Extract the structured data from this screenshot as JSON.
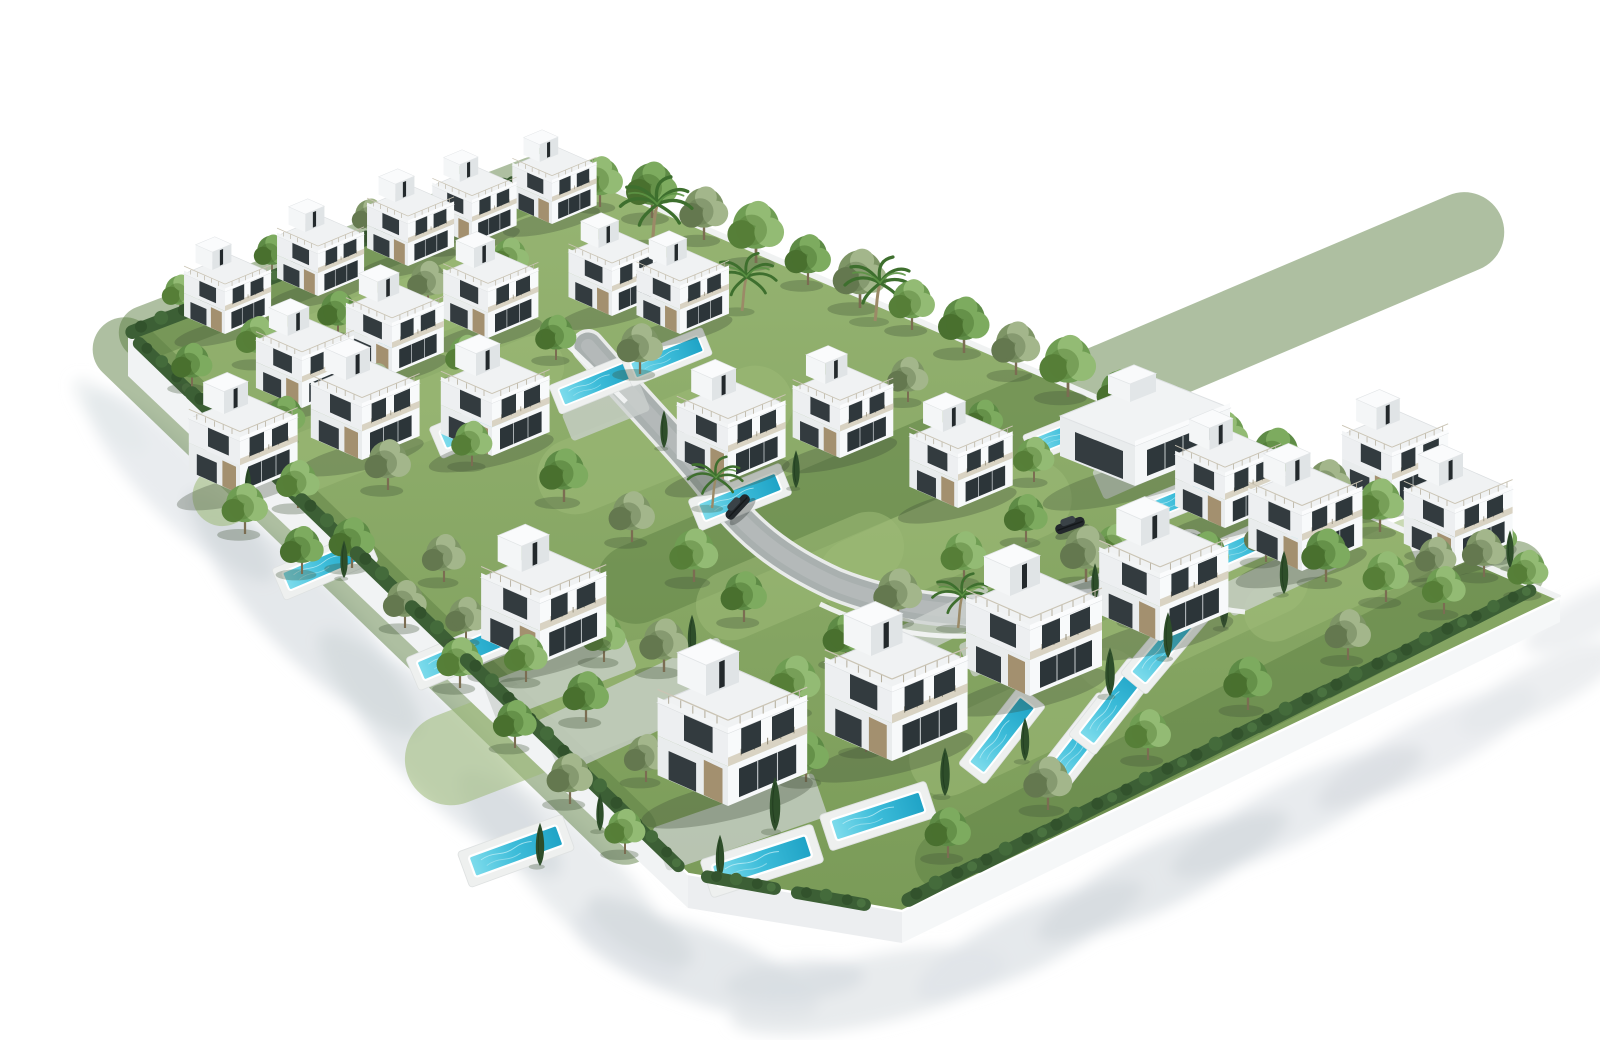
{
  "meta": {
    "description": "Aerial 3D architectural rendering of a gated residential development: twenty-five white modern villas with rooftop terraces and stair towers, private turquoise swimming pools, dense green landscaping with palms and cypresses, a curved grey access road with two dark cars, all enclosed by a white perimeter wall casting soft shadows on a white background."
  },
  "scene": {
    "canvas": {
      "w": 1600,
      "h": 1024,
      "bg": "#ffffff"
    },
    "palette": {
      "lawn_top": "#97b573",
      "lawn_bottom": "#7a9b58",
      "lawn_light": "#9cba77",
      "lawn_dark": "#5d7f43",
      "wall_sw": "#f1f3f4",
      "wall_s": "#eceef0",
      "wall_se": "#f5f7f8",
      "wall_line": "#f0f2f2",
      "road_curb": "#e9ebea",
      "road": "#a9b0af",
      "road_center": "#b6bcbb",
      "paving": "#ccd1cf",
      "inner_wall": "#f2f4f4",
      "pool_deep": "#1fa3c6",
      "pool_mid": "#3cbcd9",
      "pool_light": "#7edcec",
      "villa_white": "#f7f9fa",
      "villa_shade": "#e9eced",
      "glass": "#2c3539",
      "stone": "#a3906f",
      "car_body": "#23282c",
      "tree_variants": [
        {
          "c1": "#5e8b46",
          "c2": "#49702f",
          "c3": "#7dab5f"
        },
        {
          "c1": "#6f9d53",
          "c2": "#567f38",
          "c3": "#93bb74"
        },
        {
          "c1": "#7e9566",
          "c2": "#64784f",
          "c3": "#a3b68b"
        }
      ]
    },
    "plot": {
      "outline": [
        [
          88,
          318
        ],
        [
          520,
          150
        ],
        [
          1520,
          582
        ],
        [
          862,
          895
        ],
        [
          648,
          858
        ]
      ],
      "wall_sw": [
        [
          88,
          318
        ],
        [
          648,
          858
        ],
        [
          648,
          892
        ],
        [
          88,
          360
        ]
      ],
      "wall_s": [
        [
          648,
          858
        ],
        [
          862,
          895
        ],
        [
          862,
          927
        ],
        [
          648,
          892
        ]
      ],
      "wall_se": [
        [
          862,
          895
        ],
        [
          1520,
          582
        ],
        [
          1520,
          606
        ],
        [
          862,
          927
        ]
      ],
      "edge_nw": [
        [
          88,
          318
        ],
        [
          520,
          150
        ]
      ],
      "edge_ne": [
        [
          520,
          150
        ],
        [
          1520,
          582
        ]
      ]
    },
    "road": {
      "d": "M548,330 C600,390 640,430 672,470 C706,515 740,543 795,568 C855,592 925,600 985,593 C1048,586 1096,562 1150,530",
      "inner_walls": [
        "M780,588 C830,612 880,622 930,620",
        "M1086,556 C1130,580 1166,592 1205,596",
        "M515,318 C540,340 562,362 586,386"
      ]
    },
    "lawn_light_patches": [
      [
        350,
        302,
        230,
        64,
        -21
      ],
      [
        625,
        424,
        270,
        76,
        -22
      ],
      [
        905,
        522,
        270,
        78,
        -24
      ],
      [
        1152,
        602,
        250,
        70,
        -25
      ],
      [
        508,
        706,
        300,
        92,
        -21
      ],
      [
        252,
        452,
        210,
        60,
        -22
      ],
      [
        1302,
        564,
        210,
        60,
        -25
      ],
      [
        986,
        706,
        250,
        74,
        -25
      ],
      [
        420,
        380,
        220,
        60,
        -22
      ],
      [
        760,
        560,
        220,
        70,
        -23
      ]
    ],
    "lawn_dark_patches": [
      [
        300,
        242,
        470,
        54,
        -21
      ],
      [
        1010,
        392,
        980,
        80,
        -23
      ],
      [
        335,
        575,
        760,
        64,
        44
      ],
      [
        1190,
        700,
        700,
        60,
        -27
      ]
    ],
    "paving_patches": [
      [
        566,
        396,
        84,
        30,
        -22
      ],
      [
        1102,
        450,
        96,
        32,
        -24
      ],
      [
        908,
        606,
        100,
        34,
        -26
      ],
      [
        700,
        806,
        170,
        46,
        -19
      ],
      [
        520,
        660,
        150,
        40,
        -21
      ],
      [
        980,
        620,
        120,
        36,
        -25
      ],
      [
        1240,
        560,
        120,
        34,
        -25
      ],
      [
        600,
        690,
        200,
        60,
        -25
      ]
    ],
    "outside_shadows": [
      [
        140,
        470,
        130,
        34,
        46,
        "#e2e6e9",
        0.75
      ],
      [
        265,
        600,
        150,
        40,
        46,
        "#dde2e6",
        0.8
      ],
      [
        400,
        735,
        150,
        42,
        46,
        "#dfe3e7",
        0.8
      ],
      [
        540,
        865,
        140,
        40,
        46,
        "#e1e5e8",
        0.75
      ],
      [
        655,
        948,
        130,
        36,
        20,
        "#dde2e6",
        0.8
      ],
      [
        828,
        975,
        140,
        34,
        -12,
        "#e0e4e7",
        0.75
      ],
      [
        190,
        520,
        60,
        20,
        46,
        "#d3d9dd",
        0.7
      ],
      [
        330,
        668,
        70,
        24,
        46,
        "#d2d8dc",
        0.7
      ],
      [
        470,
        808,
        70,
        24,
        46,
        "#d4dade",
        0.7
      ],
      [
        600,
        915,
        60,
        22,
        30,
        "#d3d9dd",
        0.7
      ],
      [
        755,
        965,
        70,
        20,
        -5,
        "#d6dbdf",
        0.7
      ],
      [
        985,
        925,
        120,
        30,
        -26,
        "#dfe3e7",
        0.8
      ],
      [
        1120,
        860,
        130,
        32,
        -26,
        "#dde2e6",
        0.8
      ],
      [
        1255,
        795,
        130,
        30,
        -27,
        "#e0e4e8",
        0.75
      ],
      [
        1390,
        730,
        120,
        28,
        -27,
        "#e2e6e9",
        0.7
      ],
      [
        1500,
        672,
        90,
        24,
        -27,
        "#e4e7ea",
        0.7
      ],
      [
        1050,
        895,
        60,
        18,
        -26,
        "#d5dade",
        0.65
      ],
      [
        1190,
        828,
        65,
        20,
        -26,
        "#d4d9dd",
        0.65
      ],
      [
        1330,
        762,
        60,
        18,
        -27,
        "#d6dbdf",
        0.6
      ],
      [
        70,
        400,
        50,
        16,
        46,
        "#e3e7ea",
        0.6
      ],
      [
        1548,
        600,
        70,
        22,
        -27,
        "#e3e6e9",
        0.6
      ]
    ],
    "villas": [
      [
        185,
        318,
        0.64
      ],
      [
        278,
        280,
        0.64
      ],
      [
        368,
        250,
        0.64
      ],
      [
        432,
        228,
        0.62
      ],
      [
        512,
        208,
        0.62
      ],
      [
        262,
        392,
        0.72
      ],
      [
        352,
        358,
        0.72
      ],
      [
        448,
        322,
        0.7
      ],
      [
        572,
        300,
        0.68
      ],
      [
        640,
        318,
        0.68
      ],
      [
        200,
        478,
        0.8
      ],
      [
        322,
        444,
        0.8
      ],
      [
        452,
        440,
        0.8
      ],
      [
        688,
        465,
        0.8
      ],
      [
        800,
        442,
        0.74
      ],
      [
        918,
        492,
        0.76
      ],
      [
        1185,
        512,
        0.78
      ],
      [
        1352,
        492,
        0.78
      ],
      [
        1262,
        555,
        0.84
      ],
      [
        1415,
        550,
        0.8
      ],
      [
        500,
        648,
        0.92
      ],
      [
        688,
        790,
        1.1
      ],
      [
        852,
        745,
        1.05
      ],
      [
        990,
        680,
        1.0
      ],
      [
        1120,
        625,
        0.95
      ]
    ],
    "clubhouse": [
      [
        1095,
        470,
        1.0
      ]
    ],
    "pools": [
      [
        338,
        335,
        -23,
        0.78
      ],
      [
        441,
        408,
        -23,
        0.8
      ],
      [
        557,
        367,
        -22,
        0.74
      ],
      [
        627,
        341,
        -22,
        0.7
      ],
      [
        700,
        481,
        -22,
        0.8
      ],
      [
        285,
        549,
        -23,
        0.82
      ],
      [
        421,
        638,
        -23,
        0.85
      ],
      [
        476,
        835,
        -20,
        0.9
      ],
      [
        722,
        845,
        -18,
        0.95
      ],
      [
        838,
        800,
        -18,
        0.9
      ],
      [
        1040,
        728,
        -52,
        0.85
      ],
      [
        962,
        719,
        -52,
        0.8
      ],
      [
        1072,
        690,
        -52,
        0.8
      ],
      [
        1125,
        630,
        -50,
        0.8
      ],
      [
        1205,
        530,
        -24,
        0.8
      ],
      [
        1420,
        520,
        -24,
        0.8
      ],
      [
        1285,
        502,
        -24,
        0.75
      ],
      [
        1135,
        485,
        -22,
        0.7
      ],
      [
        1028,
        417,
        -22,
        0.7
      ]
    ],
    "trees": [
      [
        560,
        191,
        0.9,
        2
      ],
      [
        612,
        202,
        1,
        1
      ],
      [
        664,
        224,
        0.95,
        3
      ],
      [
        716,
        247,
        1.1,
        2
      ],
      [
        768,
        269,
        0.9,
        1
      ],
      [
        820,
        292,
        1.05,
        3
      ],
      [
        872,
        314,
        0.9,
        2
      ],
      [
        924,
        337,
        1,
        1
      ],
      [
        976,
        359,
        0.95,
        3
      ],
      [
        1028,
        381,
        1.1,
        2
      ],
      [
        1080,
        404,
        0.9,
        1
      ],
      [
        1132,
        426,
        1,
        3
      ],
      [
        1184,
        449,
        0.95,
        2
      ],
      [
        1236,
        471,
        1.05,
        1
      ],
      [
        1288,
        494,
        0.9,
        3
      ],
      [
        1340,
        516,
        0.95,
        2
      ],
      [
        1392,
        539,
        0.9,
        1
      ],
      [
        1444,
        561,
        0.85,
        3
      ],
      [
        1488,
        579,
        0.8,
        2
      ],
      [
        152,
        372,
        0.8,
        1
      ],
      [
        205,
        432,
        0.9,
        3
      ],
      [
        258,
        492,
        0.85,
        2
      ],
      [
        312,
        552,
        0.9,
        1
      ],
      [
        365,
        612,
        0.85,
        3
      ],
      [
        420,
        672,
        0.9,
        2
      ],
      [
        475,
        732,
        0.85,
        1
      ],
      [
        530,
        788,
        0.9,
        3
      ],
      [
        585,
        838,
        0.8,
        2
      ],
      [
        908,
        842,
        0.9,
        1
      ],
      [
        1008,
        794,
        0.95,
        3
      ],
      [
        1108,
        744,
        0.9,
        2
      ],
      [
        1208,
        694,
        0.95,
        1
      ],
      [
        1308,
        644,
        0.9,
        3
      ],
      [
        1404,
        598,
        0.85,
        2
      ],
      [
        140,
        298,
        0.7,
        2
      ],
      [
        232,
        258,
        0.7,
        1
      ],
      [
        330,
        222,
        0.7,
        3
      ],
      [
        428,
        186,
        0.7,
        2
      ],
      [
        506,
        166,
        0.65,
        1
      ],
      [
        218,
        348,
        0.85,
        2
      ],
      [
        298,
        320,
        0.8,
        1
      ],
      [
        388,
        290,
        0.8,
        3
      ],
      [
        470,
        264,
        0.75,
        2
      ],
      [
        245,
        425,
        0.8,
        1
      ],
      [
        336,
        395,
        0.85,
        3
      ],
      [
        426,
        364,
        0.8,
        2
      ],
      [
        516,
        344,
        0.8,
        1
      ],
      [
        600,
        358,
        0.9,
        3
      ],
      [
        205,
        518,
        0.9,
        2
      ],
      [
        262,
        558,
        0.85,
        1
      ],
      [
        348,
        474,
        0.9,
        3
      ],
      [
        432,
        450,
        0.8,
        2
      ],
      [
        524,
        486,
        0.95,
        1
      ],
      [
        592,
        526,
        0.9,
        3
      ],
      [
        654,
        566,
        0.95,
        2
      ],
      [
        704,
        606,
        0.9,
        1
      ],
      [
        624,
        656,
        0.95,
        3
      ],
      [
        564,
        646,
        0.85,
        2
      ],
      [
        484,
        606,
        0.9,
        1
      ],
      [
        404,
        566,
        0.85,
        3
      ],
      [
        755,
        696,
        1,
        2
      ],
      [
        806,
        648,
        0.9,
        1
      ],
      [
        858,
        606,
        0.95,
        3
      ],
      [
        924,
        566,
        0.9,
        2
      ],
      [
        986,
        526,
        0.85,
        1
      ],
      [
        1046,
        566,
        1,
        3
      ],
      [
        1106,
        606,
        0.95,
        2
      ],
      [
        1166,
        566,
        0.9,
        1
      ],
      [
        1226,
        546,
        0.85,
        3
      ],
      [
        994,
        466,
        0.8,
        2
      ],
      [
        944,
        426,
        0.75,
        1
      ],
      [
        868,
        386,
        0.8,
        3
      ],
      [
        1286,
        566,
        0.95,
        1
      ],
      [
        1346,
        586,
        0.9,
        2
      ],
      [
        1396,
        566,
        0.8,
        3
      ],
      [
        1458,
        544,
        0.75,
        1
      ],
      [
        664,
        726,
        0.9,
        2
      ],
      [
        606,
        766,
        0.85,
        3
      ],
      [
        766,
        766,
        0.9,
        1
      ],
      [
        826,
        736,
        0.9,
        2
      ],
      [
        886,
        706,
        0.85,
        3
      ],
      [
        546,
        706,
        0.9,
        1
      ],
      [
        486,
        666,
        0.85,
        2
      ],
      [
        426,
        626,
        0.8,
        3
      ],
      [
        958,
        616,
        0.8,
        1
      ],
      [
        1075,
        556,
        0.85,
        2
      ]
    ],
    "hedges": [
      [
        130,
        308,
        -21,
        1
      ],
      [
        205,
        278,
        -21,
        1
      ],
      [
        280,
        248,
        -21,
        1
      ],
      [
        355,
        218,
        -21,
        1
      ],
      [
        430,
        188,
        -21,
        1
      ],
      [
        495,
        163,
        -21,
        0.8
      ],
      [
        120,
        355,
        44,
        0.9
      ],
      [
        175,
        408,
        44,
        1
      ],
      [
        230,
        462,
        44,
        1
      ],
      [
        285,
        515,
        44,
        1
      ],
      [
        340,
        568,
        44,
        1
      ],
      [
        395,
        622,
        44,
        1
      ],
      [
        450,
        675,
        44,
        1
      ],
      [
        505,
        728,
        44,
        1
      ],
      [
        558,
        780,
        44,
        1
      ],
      [
        610,
        830,
        44,
        0.9
      ],
      [
        700,
        872,
        10,
        0.9
      ],
      [
        790,
        888,
        10,
        0.9
      ],
      [
        905,
        872,
        -27,
        1
      ],
      [
        975,
        838,
        -27,
        1
      ],
      [
        1045,
        803,
        -27,
        1
      ],
      [
        1115,
        768,
        -27,
        1
      ],
      [
        1185,
        733,
        -27,
        1
      ],
      [
        1255,
        698,
        -27,
        1
      ],
      [
        1325,
        663,
        -27,
        1
      ],
      [
        1395,
        628,
        -27,
        1
      ],
      [
        1462,
        595,
        -27,
        0.9
      ]
    ],
    "cypresses": [
      [
        735,
        815,
        1
      ],
      [
        905,
        780,
        0.9
      ],
      [
        652,
        642,
        0.8
      ],
      [
        1070,
        680,
        0.9
      ],
      [
        1128,
        642,
        0.85
      ],
      [
        756,
        472,
        0.7
      ],
      [
        624,
        432,
        0.7
      ],
      [
        1412,
        545,
        0.8
      ],
      [
        1470,
        552,
        0.7
      ],
      [
        358,
        338,
        0.6
      ],
      [
        478,
        418,
        0.6
      ],
      [
        304,
        562,
        0.7
      ],
      [
        208,
        484,
        0.6
      ],
      [
        1184,
        612,
        0.8
      ],
      [
        1244,
        578,
        0.8
      ],
      [
        500,
        850,
        0.8
      ],
      [
        560,
        815,
        0.7
      ],
      [
        680,
        862,
        0.8
      ],
      [
        985,
        745,
        0.8
      ],
      [
        1055,
        585,
        0.7
      ]
    ],
    "palms": [
      [
        612,
        228,
        1.05
      ],
      [
        702,
        295,
        0.9
      ],
      [
        835,
        305,
        1.0
      ],
      [
        918,
        612,
        0.85
      ],
      [
        672,
        492,
        0.8
      ]
    ],
    "cars": [
      [
        702,
        495,
        -47,
        0.9
      ],
      [
        1032,
        515,
        -20,
        0.9
      ]
    ]
  }
}
